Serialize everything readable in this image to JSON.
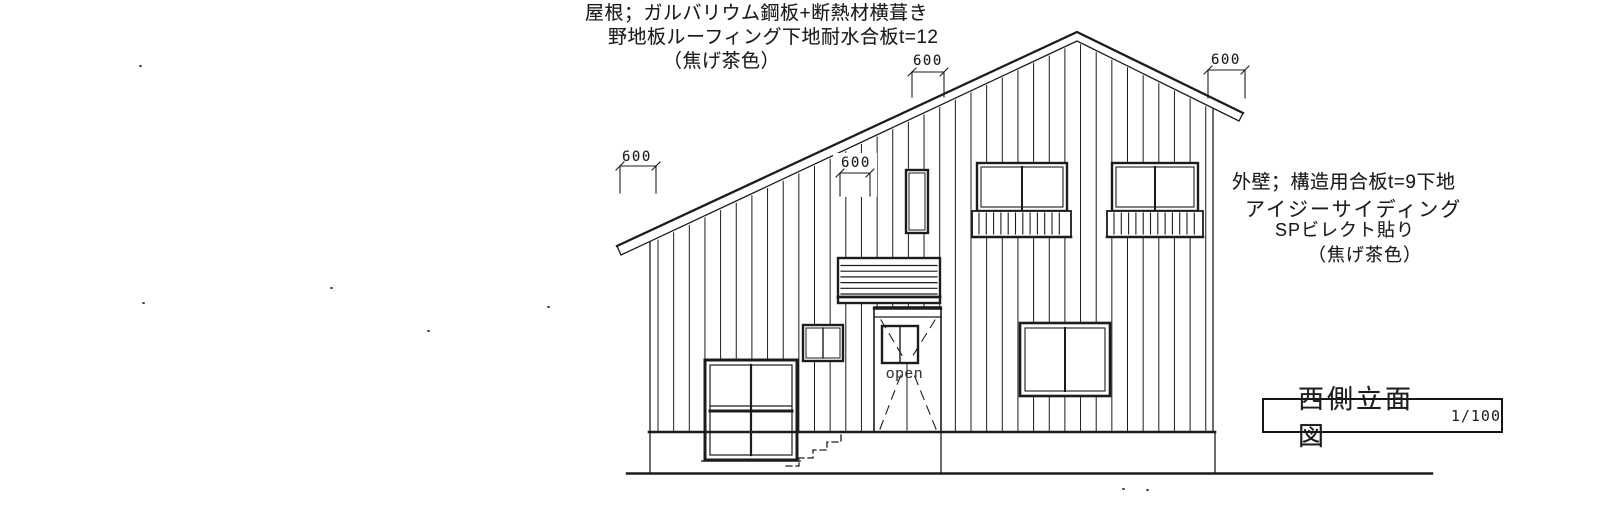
{
  "title_block": {
    "label": "西側立面図",
    "scale": "1/100"
  },
  "annotations": {
    "roof_spec": {
      "line1": "屋根；ガルバリウム鋼板+断熱材横葺き",
      "line2": "野地板ルーフィング下地耐水合板t=12",
      "line3": "（焦げ茶色）"
    },
    "wall_spec": {
      "line1": "外壁；構造用合板t=9下地",
      "line2": "アイジーサイディング",
      "line3": "SPビレクト貼り",
      "line4": "（焦げ茶色）"
    },
    "door_label": "open"
  },
  "dimensions": {
    "top": "600",
    "left": "600",
    "middle": "600",
    "right": "600"
  },
  "colors": {
    "ink": "#1c1c1c",
    "paper": "#ffffff"
  }
}
